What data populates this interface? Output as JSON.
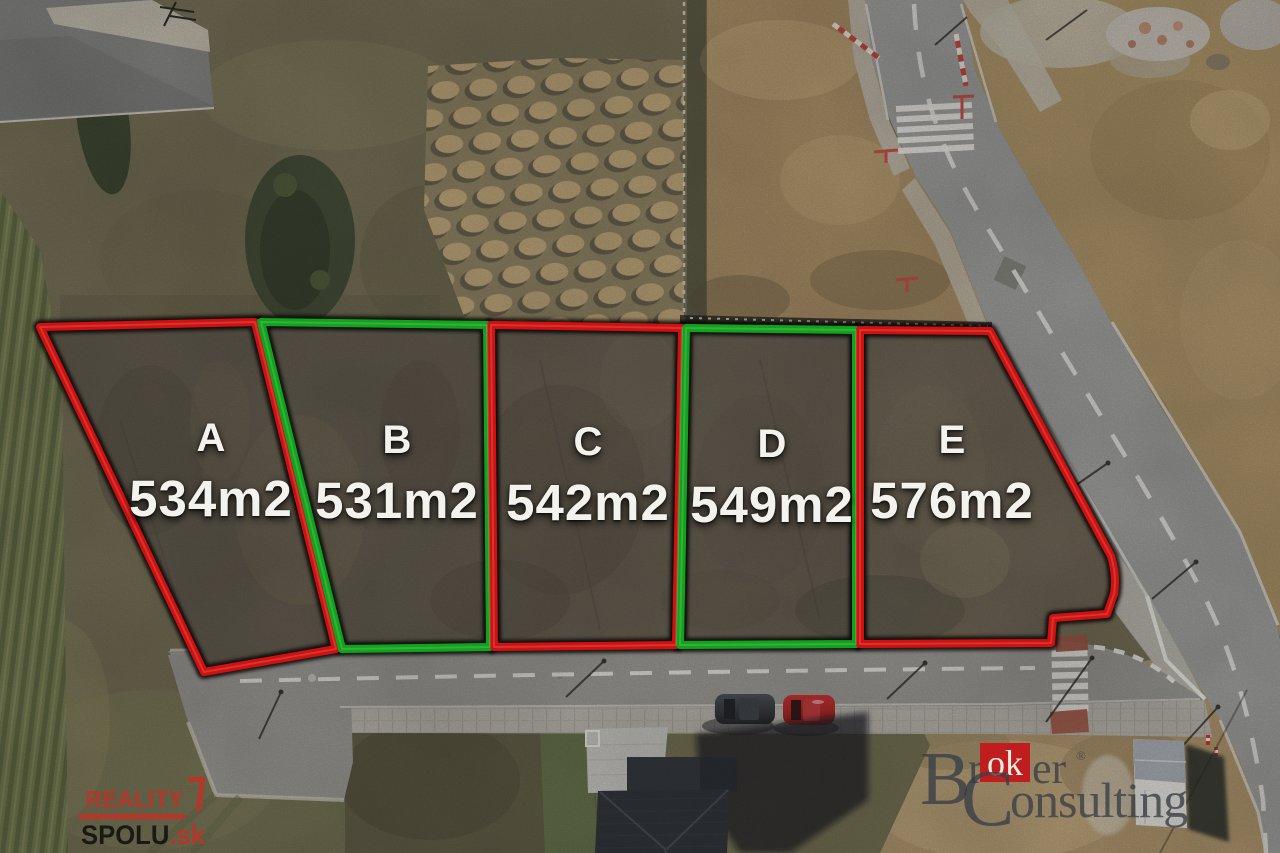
{
  "plots": [
    {
      "label": "A",
      "area": "534m2",
      "outline": "#cf1110"
    },
    {
      "label": "B",
      "area": "531m2",
      "outline": "#12a31c"
    },
    {
      "label": "C",
      "area": "542m2",
      "outline": "#cf1110"
    },
    {
      "label": "D",
      "area": "549m2",
      "outline": "#12a31c"
    },
    {
      "label": "E",
      "area": "576m2",
      "outline": "#cf1110"
    }
  ],
  "watermarks": {
    "reality_spolu": {
      "line1": "REALITY",
      "line2": "SPOLU",
      "tld": ".sk",
      "accent_color": "#c62f22"
    },
    "broker_consulting": {
      "initial1": "B",
      "r1": "r",
      "highlight": "ok",
      "r2": "er",
      "registered": "®",
      "initial2": "C",
      "rest": "onsulting",
      "box_color": "#c01d1f",
      "text_color": "#3a3f46"
    }
  }
}
